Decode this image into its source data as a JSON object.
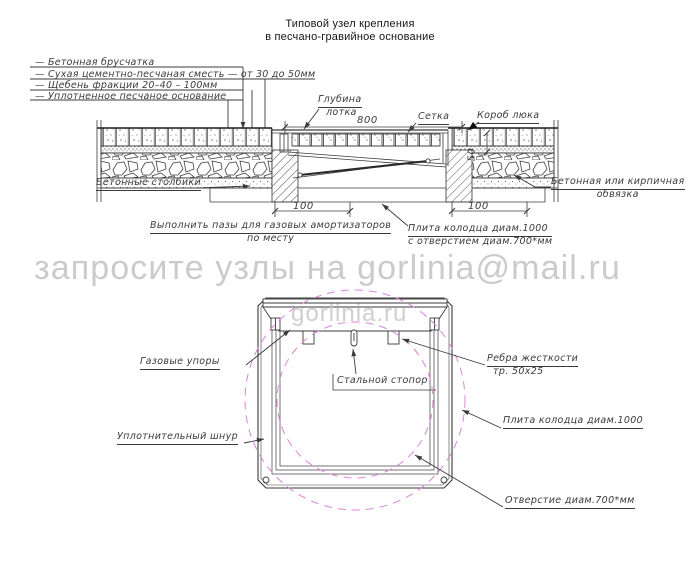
{
  "title": {
    "line1": "Типовой узел крепления",
    "line2": "в песчано-гравийное основание"
  },
  "legend": {
    "items": [
      "—  Бетонная брусчатка",
      "—  Сухая цементно-песчаная сместь — от 30 до 50мм",
      "—  Щебень фракции 20–40 – 100мм",
      "—  Уплотненное песчаное основание"
    ]
  },
  "section": {
    "tray_depth_label": {
      "line1": "Глубина",
      "line2": "лотка"
    },
    "mesh_label": "Сетка",
    "hatch_box_label": "Короб люка",
    "posts_label": "Бетонные столбики",
    "grooves_label": {
      "line1": "Выполнить пазы для газовых амортизаторов",
      "line2": "по месту"
    },
    "plate_label": {
      "line1": "Плита колодца диам.1000",
      "line2": "с отверстием диам.700*мм"
    },
    "binding_label": {
      "line1": "Бетонная или кирпичная",
      "line2": "обвязка"
    },
    "dim_width": "800",
    "dim_left": "100",
    "dim_right": "100",
    "dim_depth": "50"
  },
  "watermark": {
    "line1": "запросите узлы на gorlinia@mail.ru",
    "line2": "gorlinia.ru"
  },
  "plan": {
    "gas_struts_label": "Газовые упоры",
    "stopper_label": "Стальной стопор",
    "ribs_label": {
      "line1": "Ребра жесткости",
      "line2": "тр. 50х25"
    },
    "cord_label": "Уплотнительный шнур",
    "plate_label": "Плита колодца диам.1000",
    "hole_label": "Отверстие диам.700*мм"
  },
  "colors": {
    "line": "#3b3b3b",
    "magenta": "#da85da",
    "watermark": "#c7c7c7"
  }
}
